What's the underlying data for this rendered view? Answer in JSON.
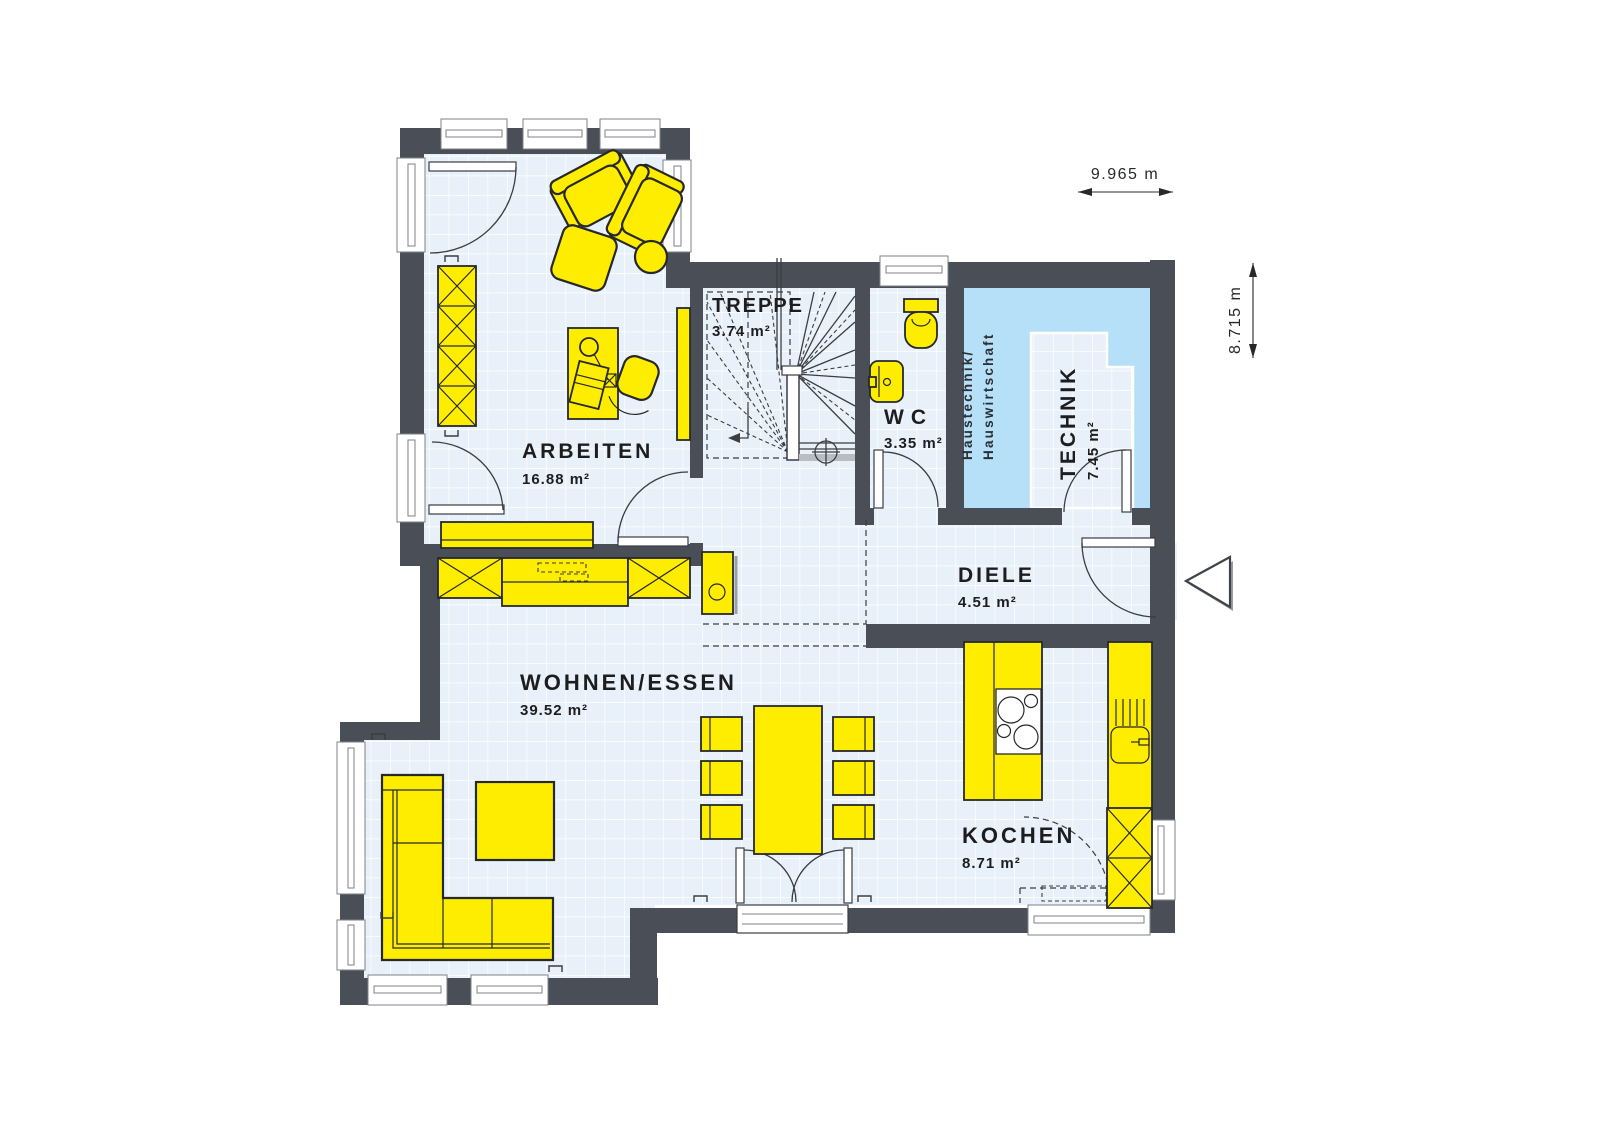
{
  "rooms": [
    {
      "id": "arbeiten",
      "name": "ARBEITEN",
      "area": "16.88 m²"
    },
    {
      "id": "treppe",
      "name": "TREPPE",
      "area": "3.74 m²"
    },
    {
      "id": "wc",
      "name": "WC",
      "area": "3.35 m²"
    },
    {
      "id": "technik",
      "name": "TECHNIK",
      "area": "7.45 m²"
    },
    {
      "id": "diele",
      "name": "DIELE",
      "area": "4.51 m²"
    },
    {
      "id": "wohnen",
      "name": "WOHNEN/ESSEN",
      "area": "39.52 m²"
    },
    {
      "id": "kochen",
      "name": "KOCHEN",
      "area": "8.71 m²"
    }
  ],
  "zone_label": {
    "line1": "Haustechnik/",
    "line2": "Hauswirtschaft"
  },
  "dimensions": {
    "width": "9.965 m",
    "height": "8.715 m"
  },
  "colors": {
    "wall": "#4a4e56",
    "floor": "#e8f1f9",
    "floor_grid": "#ffffff",
    "furniture": "#ffed00",
    "zone": "#b5e0f7",
    "outline": "#26282b"
  }
}
